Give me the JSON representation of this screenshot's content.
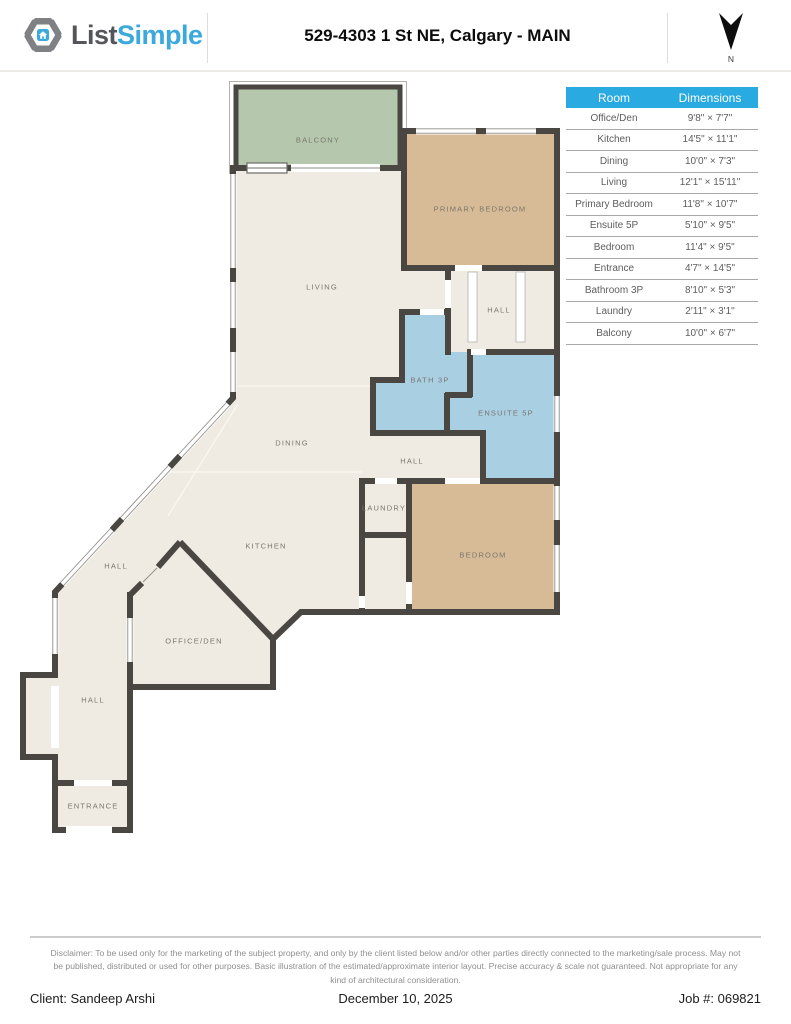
{
  "header": {
    "logo_list": "List",
    "logo_simple": "Simple",
    "title": "529-4303 1 St NE, Calgary - MAIN",
    "compass_label": "N"
  },
  "table": {
    "col_room": "Room",
    "col_dims": "Dimensions",
    "rows": [
      {
        "room": "Office/Den",
        "dims": "9'8\" × 7'7\""
      },
      {
        "room": "Kitchen",
        "dims": "14'5\" × 11'1\""
      },
      {
        "room": "Dining",
        "dims": "10'0\" × 7'3\""
      },
      {
        "room": "Living",
        "dims": "12'1\" × 15'11\""
      },
      {
        "room": "Primary Bedroom",
        "dims": "11'8\" × 10'7\""
      },
      {
        "room": "Ensuite 5P",
        "dims": "5'10\" × 9'5\""
      },
      {
        "room": "Bedroom",
        "dims": "11'4\" × 9'5\""
      },
      {
        "room": "Entrance",
        "dims": "4'7\" × 14'5\""
      },
      {
        "room": "Bathroom 3P",
        "dims": "8'10\" × 5'3\""
      },
      {
        "room": "Laundry",
        "dims": "2'11\" × 3'1\""
      },
      {
        "room": "Balcony",
        "dims": "10'0\" × 6'7\""
      }
    ]
  },
  "plan": {
    "labels": [
      "BALCONY",
      "PRIMARY BEDROOM",
      "LIVING",
      "HALL",
      "BATH 3P",
      "ENSUITE 5P",
      "DINING",
      "HALL",
      "LAUNDRY",
      "KITCHEN",
      "BEDROOM",
      "HALL",
      "OFFICE/DEN",
      "HALL",
      "ENTRANCE"
    ]
  },
  "footer": {
    "disclaimer": "Disclaimer: To be used only for the marketing of the subject property, and only by the client listed below and/or other parties directly connected to the marketing/sale process. May not be published, distributed or used for other purposes. Basic illustration of the estimated/approximate interior layout. Precise accuracy & scale not guaranteed. Not appropriate for any kind of architectural consideration.",
    "client": "Client: Sandeep Arshi",
    "date": "December 10, 2025",
    "job": "Job #: 069821"
  },
  "colors": {
    "table_header": "#29aae1",
    "wall": "#4a4642",
    "floor": "#efebe2",
    "bedroom_fill": "#d7bb96",
    "bath_fill": "#a9cfe3",
    "balcony_fill": "#b5c7ad",
    "logo_blue": "#3ba9dc",
    "logo_gray": "#55565a"
  }
}
